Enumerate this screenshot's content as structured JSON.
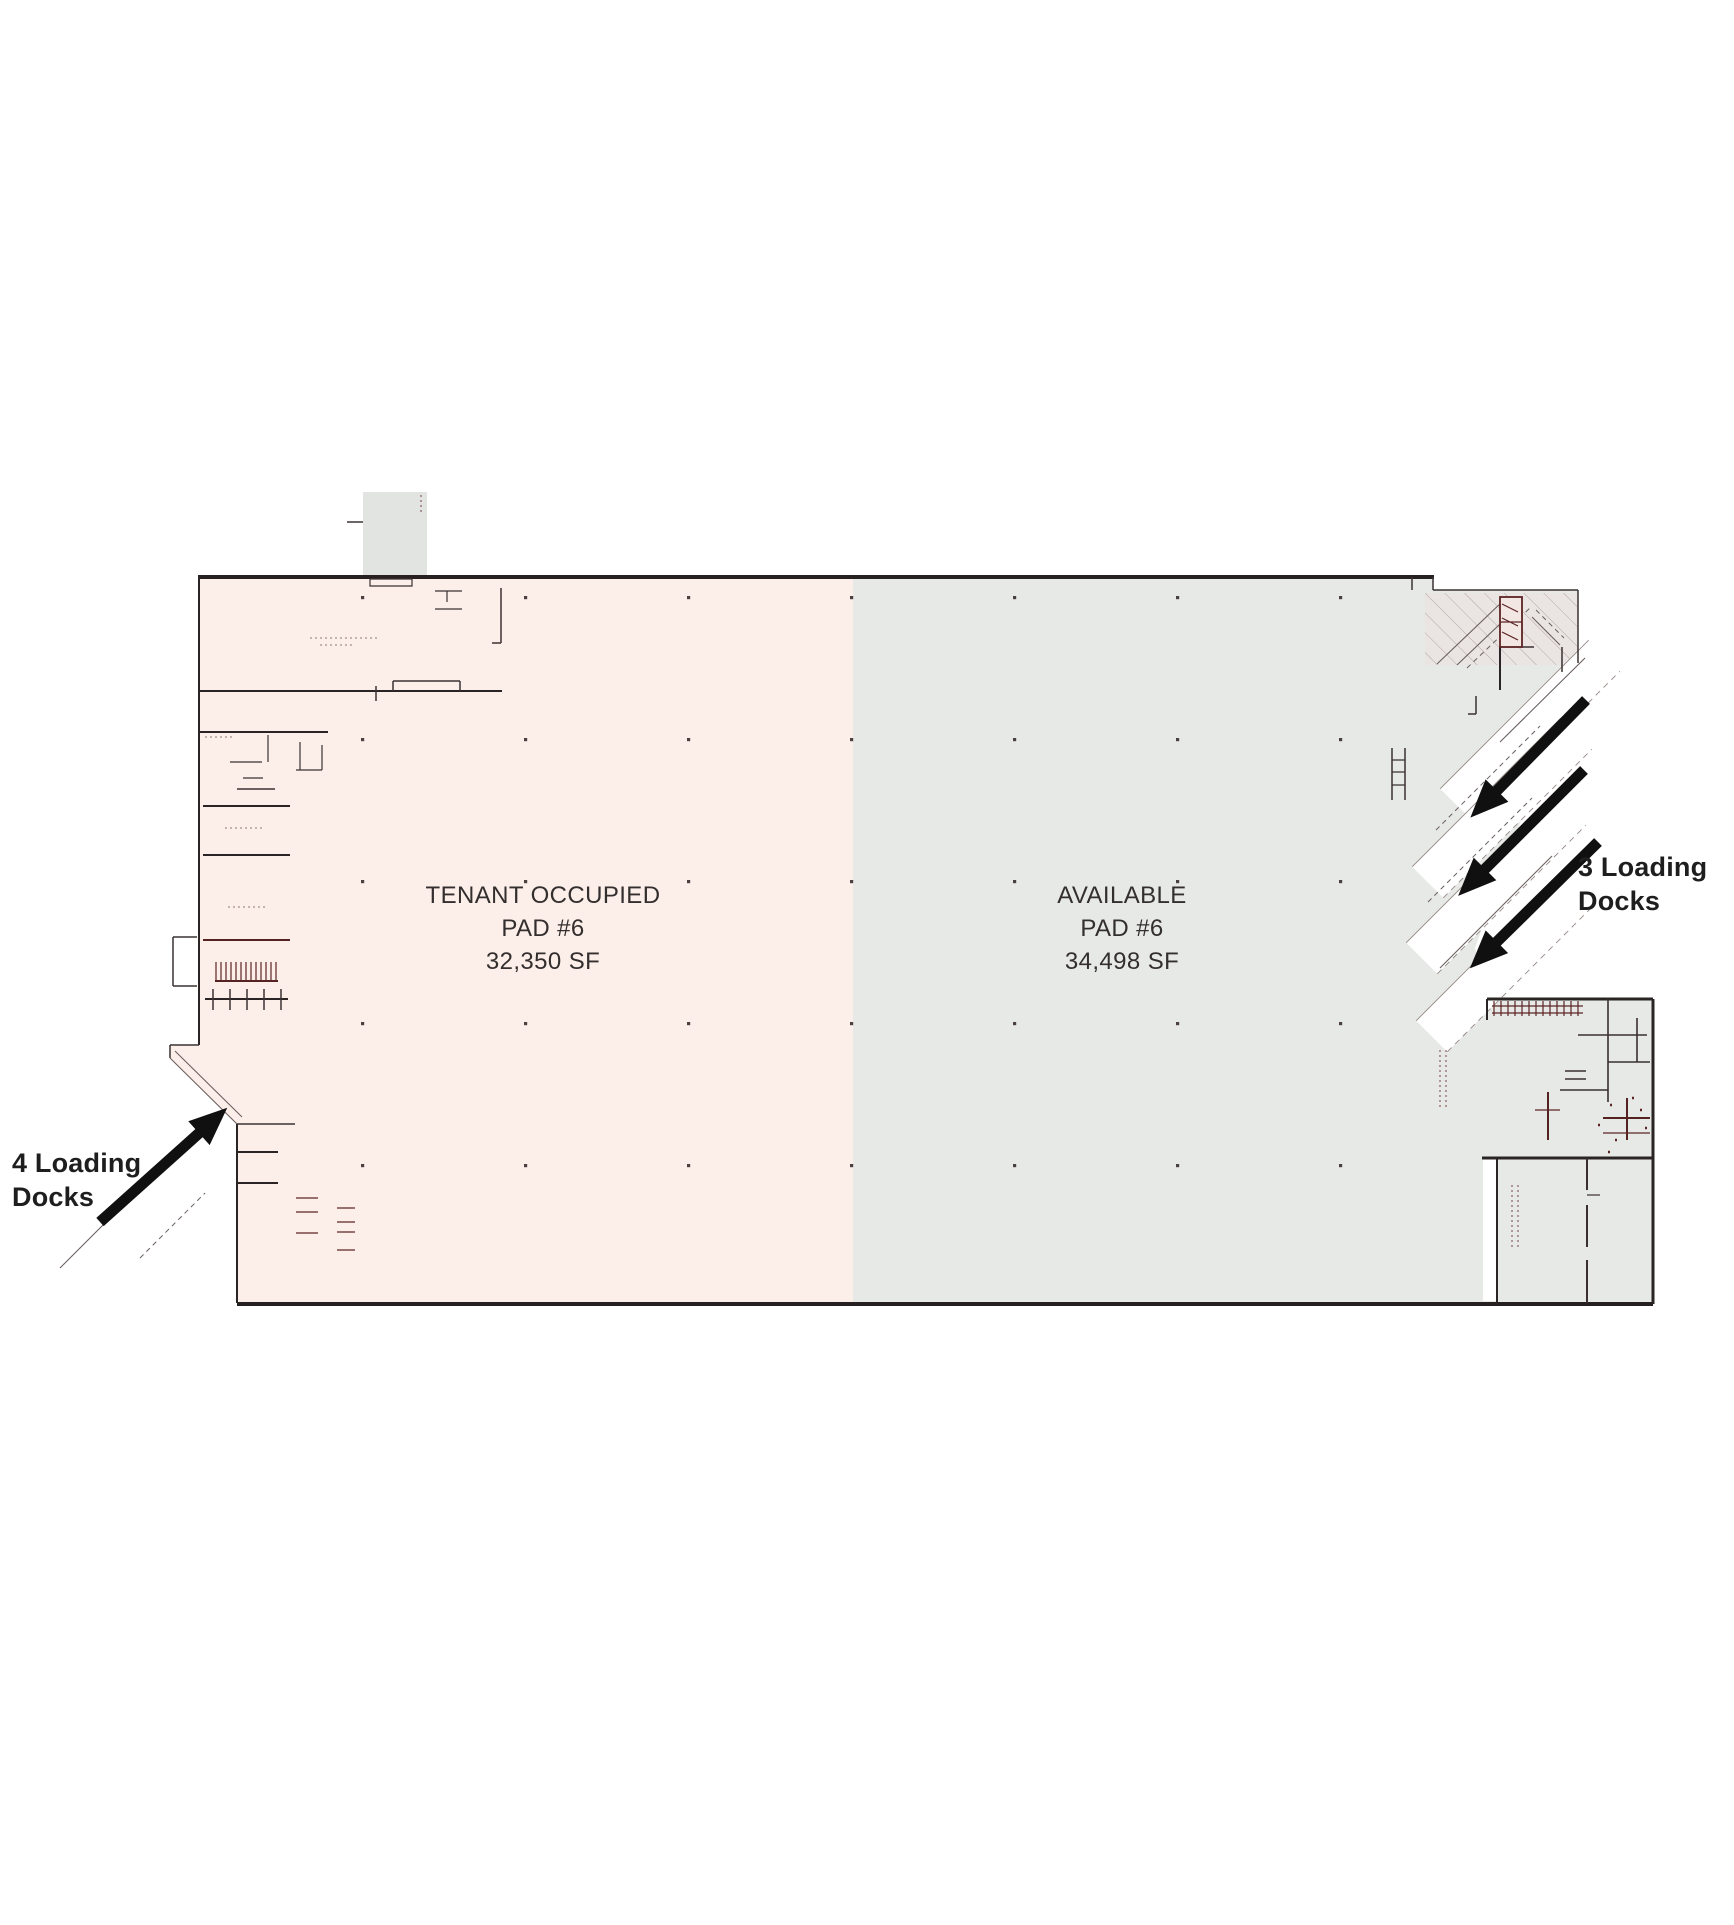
{
  "plan": {
    "tenant_pad": {
      "status": "TENANT OCCUPIED",
      "name": "PAD #6",
      "area": "32,350 SF",
      "fill": "#fcefe9"
    },
    "available_pad": {
      "status": "AVAILABLE",
      "name": "PAD #6",
      "area": "34,498 SF",
      "fill": "#e7e9e7"
    },
    "callouts": {
      "right_docks": {
        "line1": "3 Loading",
        "line2": "Docks",
        "dock_count": 3
      },
      "left_docks": {
        "line1": "4 Loading",
        "line2": "Docks",
        "dock_count": 4
      }
    },
    "colors": {
      "wall": "#2b2424",
      "detail_red": "#552222",
      "arrow": "#101010",
      "column_dot": "#4a4040"
    }
  }
}
